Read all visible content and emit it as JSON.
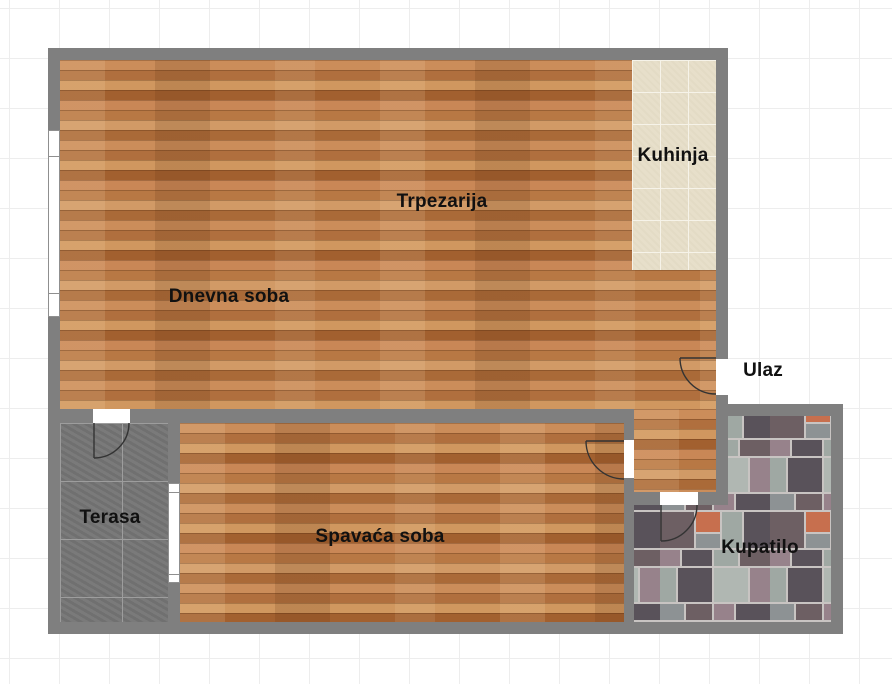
{
  "canvas": {
    "width": 892,
    "height": 684,
    "background": "#ffffff",
    "grid_color": "#ededed",
    "grid_size_px": 50
  },
  "palette": {
    "wall_gray": "#7f7f7f",
    "hardwood_base": "#c2814f",
    "kitchen_tile": "#e7dfca",
    "terrace_tile": "#757575",
    "bathroom_grout": "#c8c4c2",
    "bathroom_charcoal": "#59525a",
    "bathroom_slate": "#9fa8a3",
    "bathroom_mauve": "#97828b",
    "bathroom_orange": "#c76f4e",
    "door_arc": "#333333",
    "label_color": "#111111"
  },
  "rooms": {
    "kuhinja": {
      "label": "Kuhinja",
      "floor": "ceramic-tile"
    },
    "trpezarija": {
      "label": "Trpezarija",
      "floor": "hardwood"
    },
    "dnevna_soba": {
      "label": "Dnevna soba",
      "floor": "hardwood"
    },
    "ulaz": {
      "label": "Ulaz",
      "floor": "none"
    },
    "terasa": {
      "label": "Terasa",
      "floor": "stone-tile"
    },
    "spavaca_soba": {
      "label": "Spavaća soba",
      "floor": "hardwood"
    },
    "kupatilo": {
      "label": "Kupatilo",
      "floor": "mosaic-tile"
    }
  },
  "openings": {
    "doors": [
      "entry",
      "bedroom",
      "bathroom",
      "terrace"
    ],
    "windows": [
      "living-room-left-wall",
      "bedroom-terrace-wall"
    ]
  }
}
